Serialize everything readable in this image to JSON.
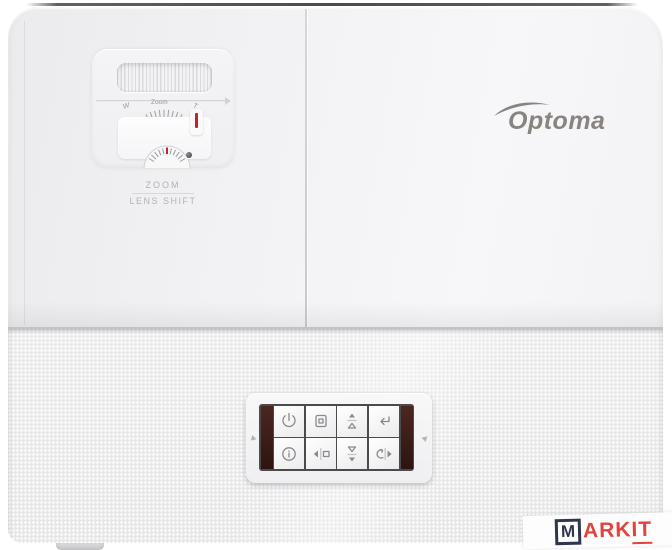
{
  "projector": {
    "brand_logo": {
      "text": "Optoma",
      "color": "#8a8480",
      "icon": "swoosh-icon"
    },
    "lens_controls": {
      "zoom_scale": {
        "wide_mark": "W",
        "scale_label": "Zoom",
        "tele_mark": "T"
      },
      "zoom_caption": "ZOOM",
      "lens_shift_caption": "LENS SHIFT",
      "indicator_color": "#c2232a"
    },
    "keypad": {
      "accent_strip_color": "#3a1f19",
      "buttons": [
        {
          "name": "power",
          "icon": "power-icon"
        },
        {
          "name": "menu",
          "icon": "menu-icon"
        },
        {
          "name": "keystone-up",
          "icon": "keystone-up-icon"
        },
        {
          "name": "enter",
          "icon": "enter-icon"
        },
        {
          "name": "info",
          "icon": "info-icon"
        },
        {
          "name": "source-left",
          "icon": "left-arrow-source-icon"
        },
        {
          "name": "keystone-down",
          "icon": "keystone-down-icon"
        },
        {
          "name": "resync-right",
          "icon": "resync-right-arrow-icon"
        }
      ]
    }
  },
  "watermark": {
    "box_letter": "M",
    "text": "ARK",
    "text_underlined": "IT",
    "box_color": "#2d3850",
    "text_color": "#e0443b"
  }
}
